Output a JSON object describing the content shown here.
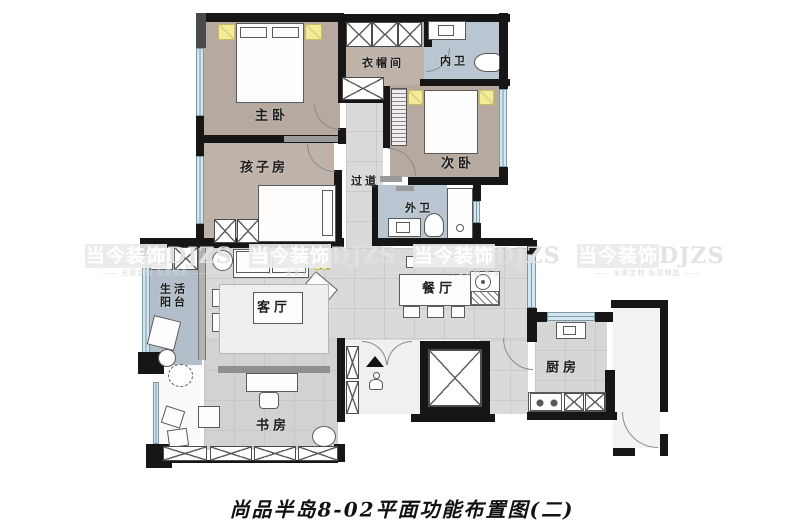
{
  "image_type": "residential floor plan",
  "caption": "尚品半岛8-02平面功能布置图(二)",
  "watermark": {
    "brand": "当今装饰",
    "abbr": "DJZS",
    "slogan": "—— 全案定制 私享臻品 ——"
  },
  "rooms": {
    "master_bedroom": {
      "label": "主卧"
    },
    "kids_room": {
      "label": "孩子房"
    },
    "cloakroom": {
      "label": "衣帽间"
    },
    "inner_bath": {
      "label": "内卫"
    },
    "second_bedroom": {
      "label": "次卧"
    },
    "hallway": {
      "label": "过道"
    },
    "outer_bath": {
      "label": "外卫"
    },
    "service_balcony": {
      "label_line1": "生活",
      "label_line2": "阳台"
    },
    "living_room": {
      "label": "客厅"
    },
    "dining_room": {
      "label": "餐厅"
    },
    "kitchen": {
      "label": "厨房"
    },
    "study": {
      "label": "书房"
    }
  },
  "colors": {
    "wall": "#161616",
    "bedroom_fill": "#b6aaa0",
    "bathroom_fill": "#b9c5d0",
    "balcony_fill": "#b2bfca",
    "public_floor_fill": "#dadada",
    "window_fill": "#d3e7f0",
    "lamp_accent": "#f4eb96",
    "watermark_gray": "#e8e8e8"
  }
}
